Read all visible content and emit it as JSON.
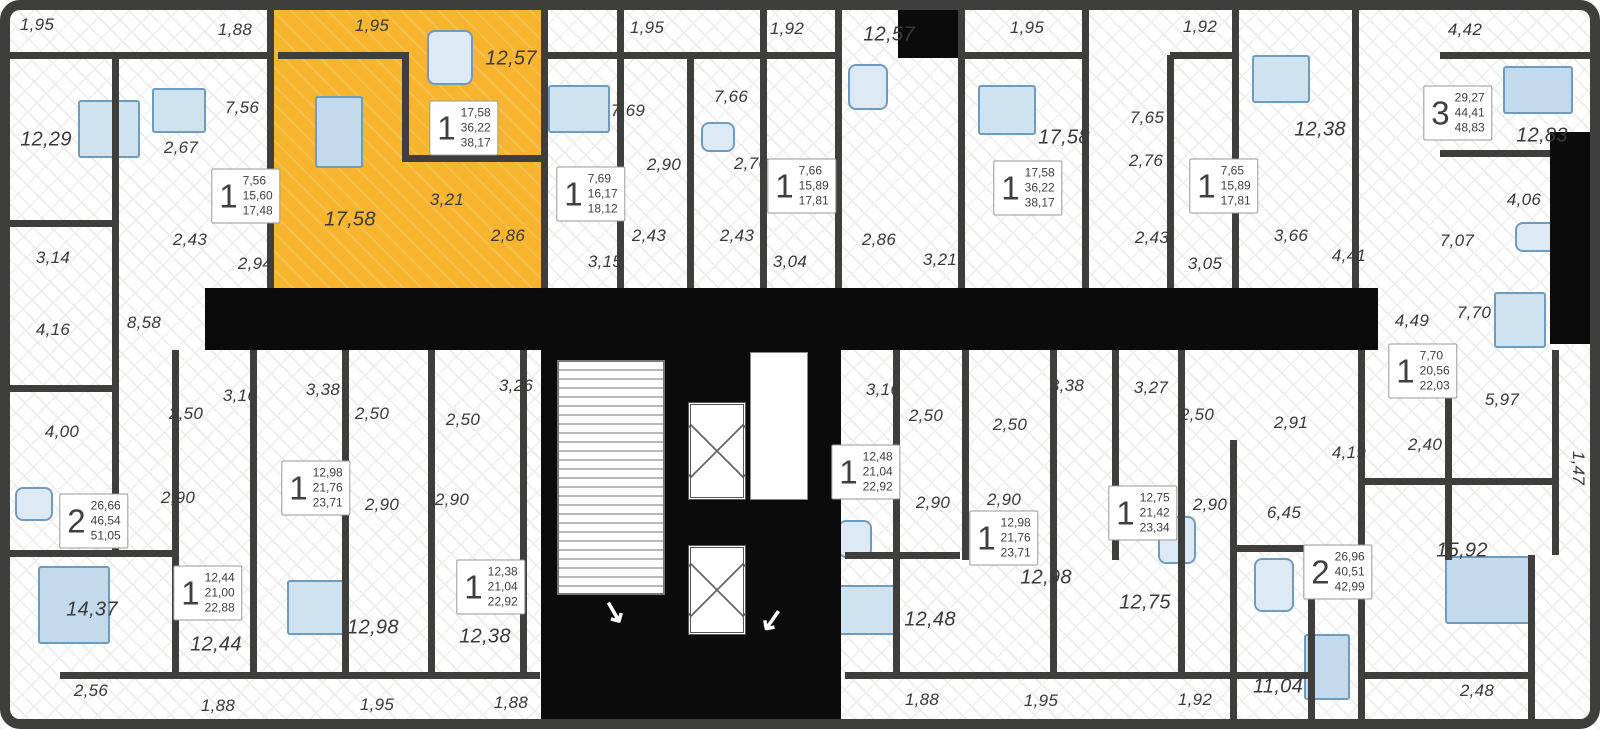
{
  "plan": {
    "colors": {
      "highlight": "#F6B42F",
      "wall": "#3E3E3C",
      "core": "#0b0b0b",
      "furniture_fill": "#cfe2f0",
      "furniture_stroke": "#6e9cc0",
      "label_text": "#3a3a3a"
    },
    "highlighted_unit": {
      "x": 274,
      "y": 8,
      "w": 267,
      "h": 281
    },
    "room_labels": [
      {
        "text": "1,95",
        "x": 37,
        "y": 25
      },
      {
        "text": "1,88",
        "x": 235,
        "y": 30
      },
      {
        "text": "1,95",
        "x": 372,
        "y": 26
      },
      {
        "text": "12,57",
        "x": 511,
        "y": 59
      },
      {
        "text": "1,95",
        "x": 647,
        "y": 28
      },
      {
        "text": "1,92",
        "x": 787,
        "y": 29
      },
      {
        "text": "12,57",
        "x": 889,
        "y": 35
      },
      {
        "text": "1,95",
        "x": 1027,
        "y": 28
      },
      {
        "text": "1,92",
        "x": 1200,
        "y": 27
      },
      {
        "text": "4,42",
        "x": 1465,
        "y": 30
      },
      {
        "text": "12,29",
        "x": 46,
        "y": 140
      },
      {
        "text": "7,56",
        "x": 242,
        "y": 108
      },
      {
        "text": "2,67",
        "x": 181,
        "y": 148
      },
      {
        "text": "7,69",
        "x": 628,
        "y": 111
      },
      {
        "text": "7,66",
        "x": 731,
        "y": 97
      },
      {
        "text": "2,90",
        "x": 664,
        "y": 165
      },
      {
        "text": "2,76",
        "x": 751,
        "y": 164
      },
      {
        "text": "17,58",
        "x": 1064,
        "y": 138
      },
      {
        "text": "7,65",
        "x": 1147,
        "y": 118
      },
      {
        "text": "2,76",
        "x": 1146,
        "y": 161
      },
      {
        "text": "12,38",
        "x": 1320,
        "y": 130
      },
      {
        "text": "12,83",
        "x": 1542,
        "y": 136
      },
      {
        "text": "17,58",
        "x": 350,
        "y": 220
      },
      {
        "text": "3,21",
        "x": 447,
        "y": 200
      },
      {
        "text": "2,86",
        "x": 508,
        "y": 236
      },
      {
        "text": "2,43",
        "x": 190,
        "y": 240
      },
      {
        "text": "2,94",
        "x": 255,
        "y": 264
      },
      {
        "text": "3,14",
        "x": 53,
        "y": 258
      },
      {
        "text": "2,43",
        "x": 649,
        "y": 236
      },
      {
        "text": "2,43",
        "x": 737,
        "y": 236
      },
      {
        "text": "2,86",
        "x": 879,
        "y": 240
      },
      {
        "text": "3,21",
        "x": 940,
        "y": 260
      },
      {
        "text": "2,43",
        "x": 1152,
        "y": 238
      },
      {
        "text": "3,05",
        "x": 1205,
        "y": 264
      },
      {
        "text": "3,66",
        "x": 1291,
        "y": 236
      },
      {
        "text": "4,41",
        "x": 1349,
        "y": 256
      },
      {
        "text": "3,15",
        "x": 605,
        "y": 262
      },
      {
        "text": "3,04",
        "x": 790,
        "y": 262
      },
      {
        "text": "4,06",
        "x": 1524,
        "y": 200
      },
      {
        "text": "7,07",
        "x": 1457,
        "y": 241
      },
      {
        "text": "8,58",
        "x": 144,
        "y": 323
      },
      {
        "text": "4,16",
        "x": 53,
        "y": 330
      },
      {
        "text": "4,49",
        "x": 1412,
        "y": 321
      },
      {
        "text": "7,70",
        "x": 1474,
        "y": 313
      },
      {
        "text": "3,16",
        "x": 240,
        "y": 396
      },
      {
        "text": "3,38",
        "x": 323,
        "y": 390
      },
      {
        "text": "3,26",
        "x": 516,
        "y": 386
      },
      {
        "text": "3,16",
        "x": 883,
        "y": 390
      },
      {
        "text": "3,38",
        "x": 1067,
        "y": 386
      },
      {
        "text": "3,27",
        "x": 1151,
        "y": 388
      },
      {
        "text": "2,50",
        "x": 186,
        "y": 414
      },
      {
        "text": "2,50",
        "x": 372,
        "y": 414
      },
      {
        "text": "2,50",
        "x": 463,
        "y": 420
      },
      {
        "text": "2,50",
        "x": 926,
        "y": 416
      },
      {
        "text": "2,50",
        "x": 1010,
        "y": 425
      },
      {
        "text": "2,50",
        "x": 1197,
        "y": 415
      },
      {
        "text": "2,91",
        "x": 1291,
        "y": 423
      },
      {
        "text": "5,97",
        "x": 1502,
        "y": 400
      },
      {
        "text": "4,00",
        "x": 62,
        "y": 432
      },
      {
        "text": "2,40",
        "x": 1425,
        "y": 445
      },
      {
        "text": "4,19",
        "x": 1349,
        "y": 453
      },
      {
        "text": "1,47",
        "x": 1578,
        "y": 468,
        "rot": 90
      },
      {
        "text": "2,90",
        "x": 178,
        "y": 498
      },
      {
        "text": "2,90",
        "x": 382,
        "y": 505
      },
      {
        "text": "2,90",
        "x": 452,
        "y": 500
      },
      {
        "text": "2,90",
        "x": 933,
        "y": 503
      },
      {
        "text": "2,90",
        "x": 1004,
        "y": 500
      },
      {
        "text": "2,90",
        "x": 1210,
        "y": 505
      },
      {
        "text": "6,45",
        "x": 1284,
        "y": 513
      },
      {
        "text": "14,37",
        "x": 92,
        "y": 610
      },
      {
        "text": "12,44",
        "x": 216,
        "y": 645
      },
      {
        "text": "12,98",
        "x": 373,
        "y": 628
      },
      {
        "text": "12,38",
        "x": 485,
        "y": 637
      },
      {
        "text": "12,48",
        "x": 930,
        "y": 620
      },
      {
        "text": "12,98",
        "x": 1046,
        "y": 578
      },
      {
        "text": "12,75",
        "x": 1145,
        "y": 603
      },
      {
        "text": "15,92",
        "x": 1462,
        "y": 551
      },
      {
        "text": "11,04",
        "x": 1278,
        "y": 687
      },
      {
        "text": "2,56",
        "x": 91,
        "y": 691
      },
      {
        "text": "1,88",
        "x": 218,
        "y": 706
      },
      {
        "text": "1,95",
        "x": 377,
        "y": 705
      },
      {
        "text": "1,88",
        "x": 511,
        "y": 703
      },
      {
        "text": "1,88",
        "x": 922,
        "y": 700
      },
      {
        "text": "1,95",
        "x": 1041,
        "y": 701
      },
      {
        "text": "1,92",
        "x": 1195,
        "y": 700
      },
      {
        "text": "2,48",
        "x": 1477,
        "y": 691
      }
    ],
    "unit_cards": [
      {
        "rooms": "1",
        "values": [
          "7,56",
          "15,60",
          "17,48"
        ],
        "x": 246,
        "y": 196
      },
      {
        "rooms": "1",
        "values": [
          "17,58",
          "36,22",
          "38,17"
        ],
        "x": 464,
        "y": 128
      },
      {
        "rooms": "1",
        "values": [
          "7,69",
          "16,17",
          "18,12"
        ],
        "x": 591,
        "y": 194
      },
      {
        "rooms": "1",
        "values": [
          "7,66",
          "15,89",
          "17,81"
        ],
        "x": 802,
        "y": 186
      },
      {
        "rooms": "1",
        "values": [
          "17,58",
          "36,22",
          "38,17"
        ],
        "x": 1028,
        "y": 188
      },
      {
        "rooms": "1",
        "values": [
          "7,65",
          "15,89",
          "17,81"
        ],
        "x": 1224,
        "y": 186
      },
      {
        "rooms": "3",
        "values": [
          "29,27",
          "44,41",
          "48,83"
        ],
        "x": 1458,
        "y": 113
      },
      {
        "rooms": "1",
        "values": [
          "7,70",
          "20,56",
          "22,03"
        ],
        "x": 1423,
        "y": 371
      },
      {
        "rooms": "1",
        "values": [
          "12,98",
          "21,76",
          "23,71"
        ],
        "x": 316,
        "y": 488
      },
      {
        "rooms": "1",
        "values": [
          "12,48",
          "21,04",
          "22,92"
        ],
        "x": 866,
        "y": 472
      },
      {
        "rooms": "1",
        "values": [
          "12,75",
          "21,42",
          "23,34"
        ],
        "x": 1143,
        "y": 513
      },
      {
        "rooms": "2",
        "values": [
          "26,66",
          "46,54",
          "51,05"
        ],
        "x": 94,
        "y": 521
      },
      {
        "rooms": "1",
        "values": [
          "12,44",
          "21,00",
          "22,88"
        ],
        "x": 208,
        "y": 593
      },
      {
        "rooms": "1",
        "values": [
          "12,38",
          "21,04",
          "22,92"
        ],
        "x": 491,
        "y": 587
      },
      {
        "rooms": "1",
        "values": [
          "12,98",
          "21,76",
          "23,71"
        ],
        "x": 1004,
        "y": 538
      },
      {
        "rooms": "2",
        "values": [
          "26,96",
          "40,51",
          "42,99"
        ],
        "x": 1338,
        "y": 572
      }
    ],
    "geometry": {
      "blacks": [
        {
          "x": 205,
          "y": 288,
          "w": 336,
          "h": 62
        },
        {
          "x": 838,
          "y": 288,
          "w": 540,
          "h": 62
        },
        {
          "x": 541,
          "y": 288,
          "w": 300,
          "h": 434
        },
        {
          "x": 1550,
          "y": 132,
          "w": 50,
          "h": 212
        },
        {
          "x": 898,
          "y": 0,
          "w": 60,
          "h": 58
        }
      ],
      "lobbies": [
        {
          "x": 750,
          "y": 352,
          "w": 58,
          "h": 148
        }
      ],
      "stairs": [
        {
          "x": 557,
          "y": 360,
          "w": 108,
          "h": 235
        }
      ],
      "elevators": [
        {
          "x": 688,
          "y": 402,
          "w": 58,
          "h": 98
        },
        {
          "x": 688,
          "y": 545,
          "w": 58,
          "h": 90
        }
      ],
      "arrows": [
        {
          "glyph": "↘",
          "x": 614,
          "y": 612,
          "rot": 15
        },
        {
          "glyph": "↙",
          "x": 772,
          "y": 620,
          "rot": -10
        }
      ],
      "walls": [
        {
          "x": 0,
          "y": 52,
          "w": 270,
          "h": 7
        },
        {
          "x": 278,
          "y": 52,
          "w": 130,
          "h": 7
        },
        {
          "x": 545,
          "y": 52,
          "w": 295,
          "h": 7
        },
        {
          "x": 962,
          "y": 52,
          "w": 123,
          "h": 7
        },
        {
          "x": 1170,
          "y": 52,
          "w": 68,
          "h": 7
        },
        {
          "x": 1440,
          "y": 52,
          "w": 160,
          "h": 7
        },
        {
          "x": 1440,
          "y": 150,
          "w": 160,
          "h": 7
        },
        {
          "x": 267,
          "y": 0,
          "w": 7,
          "h": 292
        },
        {
          "x": 541,
          "y": 0,
          "w": 7,
          "h": 292
        },
        {
          "x": 617,
          "y": 0,
          "w": 7,
          "h": 292
        },
        {
          "x": 687,
          "y": 55,
          "w": 7,
          "h": 237
        },
        {
          "x": 760,
          "y": 0,
          "w": 7,
          "h": 292
        },
        {
          "x": 835,
          "y": 0,
          "w": 7,
          "h": 292
        },
        {
          "x": 958,
          "y": 0,
          "w": 7,
          "h": 292
        },
        {
          "x": 1082,
          "y": 0,
          "w": 7,
          "h": 292
        },
        {
          "x": 1167,
          "y": 55,
          "w": 7,
          "h": 237
        },
        {
          "x": 1232,
          "y": 0,
          "w": 7,
          "h": 292
        },
        {
          "x": 1352,
          "y": 0,
          "w": 7,
          "h": 292
        },
        {
          "x": 112,
          "y": 52,
          "w": 7,
          "h": 505
        },
        {
          "x": 0,
          "y": 220,
          "w": 115,
          "h": 7
        },
        {
          "x": 0,
          "y": 385,
          "w": 115,
          "h": 7
        },
        {
          "x": 0,
          "y": 550,
          "w": 175,
          "h": 7
        },
        {
          "x": 402,
          "y": 52,
          "w": 7,
          "h": 105
        },
        {
          "x": 402,
          "y": 155,
          "w": 139,
          "h": 7
        },
        {
          "x": 172,
          "y": 350,
          "w": 7,
          "h": 325
        },
        {
          "x": 250,
          "y": 350,
          "w": 7,
          "h": 325
        },
        {
          "x": 342,
          "y": 350,
          "w": 7,
          "h": 325
        },
        {
          "x": 428,
          "y": 350,
          "w": 7,
          "h": 325
        },
        {
          "x": 520,
          "y": 350,
          "w": 7,
          "h": 325
        },
        {
          "x": 893,
          "y": 350,
          "w": 7,
          "h": 325
        },
        {
          "x": 962,
          "y": 350,
          "w": 7,
          "h": 210
        },
        {
          "x": 1050,
          "y": 350,
          "w": 7,
          "h": 325
        },
        {
          "x": 1112,
          "y": 350,
          "w": 7,
          "h": 210
        },
        {
          "x": 1178,
          "y": 350,
          "w": 7,
          "h": 325
        },
        {
          "x": 1230,
          "y": 440,
          "w": 7,
          "h": 285
        },
        {
          "x": 1308,
          "y": 560,
          "w": 7,
          "h": 165
        },
        {
          "x": 1358,
          "y": 350,
          "w": 7,
          "h": 370
        },
        {
          "x": 1445,
          "y": 350,
          "w": 7,
          "h": 210
        },
        {
          "x": 1528,
          "y": 555,
          "w": 7,
          "h": 170
        },
        {
          "x": 1552,
          "y": 350,
          "w": 7,
          "h": 205
        },
        {
          "x": 1232,
          "y": 545,
          "w": 126,
          "h": 7
        },
        {
          "x": 1360,
          "y": 478,
          "w": 192,
          "h": 7
        },
        {
          "x": 845,
          "y": 552,
          "w": 115,
          "h": 7
        },
        {
          "x": 60,
          "y": 672,
          "w": 480,
          "h": 7
        },
        {
          "x": 845,
          "y": 672,
          "w": 465,
          "h": 7
        },
        {
          "x": 1360,
          "y": 672,
          "w": 170,
          "h": 7
        }
      ]
    },
    "furniture": [
      {
        "t": "bed",
        "x": 78,
        "y": 100,
        "w": 62,
        "h": 58
      },
      {
        "t": "bed",
        "x": 152,
        "y": 88,
        "w": 54,
        "h": 45
      },
      {
        "t": "sofa",
        "x": 315,
        "y": 96,
        "w": 48,
        "h": 72
      },
      {
        "t": "table",
        "x": 427,
        "y": 30,
        "w": 46,
        "h": 55
      },
      {
        "t": "bed",
        "x": 548,
        "y": 85,
        "w": 62,
        "h": 48
      },
      {
        "t": "bed",
        "x": 978,
        "y": 85,
        "w": 58,
        "h": 50
      },
      {
        "t": "table",
        "x": 701,
        "y": 122,
        "w": 34,
        "h": 30
      },
      {
        "t": "table",
        "x": 848,
        "y": 64,
        "w": 40,
        "h": 46
      },
      {
        "t": "bed",
        "x": 1252,
        "y": 55,
        "w": 58,
        "h": 48
      },
      {
        "t": "sofa",
        "x": 1503,
        "y": 66,
        "w": 70,
        "h": 48
      },
      {
        "t": "bed",
        "x": 1494,
        "y": 292,
        "w": 52,
        "h": 56
      },
      {
        "t": "table",
        "x": 1515,
        "y": 222,
        "w": 48,
        "h": 30
      },
      {
        "t": "sofa",
        "x": 38,
        "y": 566,
        "w": 72,
        "h": 78
      },
      {
        "t": "table",
        "x": 15,
        "y": 487,
        "w": 38,
        "h": 34
      },
      {
        "t": "bed",
        "x": 287,
        "y": 580,
        "w": 58,
        "h": 55
      },
      {
        "t": "bed",
        "x": 837,
        "y": 585,
        "w": 60,
        "h": 50
      },
      {
        "t": "table",
        "x": 838,
        "y": 520,
        "w": 34,
        "h": 38
      },
      {
        "t": "table",
        "x": 1158,
        "y": 516,
        "w": 38,
        "h": 48
      },
      {
        "t": "sofa",
        "x": 1445,
        "y": 556,
        "w": 90,
        "h": 68
      },
      {
        "t": "table",
        "x": 1254,
        "y": 558,
        "w": 40,
        "h": 54
      },
      {
        "t": "sofa",
        "x": 1304,
        "y": 634,
        "w": 46,
        "h": 66
      }
    ]
  }
}
